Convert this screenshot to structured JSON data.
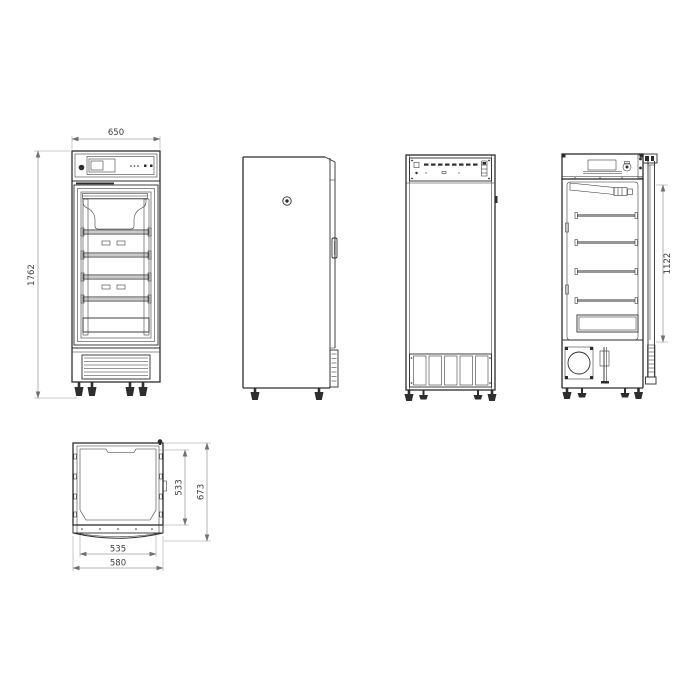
{
  "canvas": {
    "width": 700,
    "height": 700,
    "background": "#ffffff"
  },
  "style": {
    "part_line_color": "#2d2d2d",
    "dim_line_color": "#707070",
    "dim_text_color": "#3d3d3d"
  },
  "drawing": {
    "kind": "orthographic technical drawing, upright single-door refrigerator",
    "views": {
      "front": {
        "dims": {
          "width": "650",
          "height": "1762"
        }
      },
      "section": {
        "dims": {
          "interior_height": "1122"
        }
      },
      "plan": {
        "dims": {
          "inner_depth": "533",
          "overall_depth": "673",
          "inner_width": "535",
          "overall_width": "580"
        }
      }
    }
  }
}
